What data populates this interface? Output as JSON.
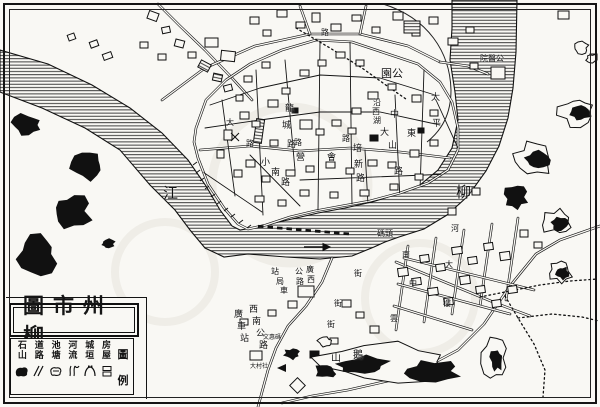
{
  "colors": {
    "ink": "#141414",
    "paper": "#f9f8f4",
    "water_hatch": "#2b2b2b"
  },
  "title_box": {
    "text": "圖市州柳"
  },
  "legend": {
    "title_chars": [
      "圖",
      "例"
    ],
    "items": [
      {
        "label_top": "石",
        "label_bottom": "山",
        "symbol": "hill-symbol"
      },
      {
        "label_top": "道",
        "label_bottom": "路",
        "symbol": "road-symbol"
      },
      {
        "label_top": "池",
        "label_bottom": "塘",
        "symbol": "pond-symbol"
      },
      {
        "label_top": "河",
        "label_bottom": "流",
        "symbol": "river-symbol"
      },
      {
        "label_top": "城",
        "label_bottom": "垣",
        "symbol": "wall-symbol"
      },
      {
        "label_top": "房",
        "label_bottom": "屋",
        "symbol": "house-symbol"
      }
    ]
  },
  "river": {
    "name": "柳江"
  },
  "map_labels": [
    {
      "t": "江",
      "x": 163,
      "y": 186,
      "s": 15,
      "name": "river-name-jiang"
    },
    {
      "t": "柳",
      "x": 456,
      "y": 185,
      "s": 15,
      "name": "river-name-liu"
    },
    {
      "t": "園公",
      "x": 381,
      "y": 68,
      "s": 11,
      "name": "park-label"
    },
    {
      "t": "院醫公",
      "x": 480,
      "y": 55,
      "s": 8,
      "name": "hospital-label"
    },
    {
      "t": "龍",
      "x": 285,
      "y": 105,
      "s": 9
    },
    {
      "t": "城",
      "x": 282,
      "y": 122,
      "s": 9
    },
    {
      "t": "路",
      "x": 287,
      "y": 141,
      "s": 9
    },
    {
      "t": "小",
      "x": 261,
      "y": 159,
      "s": 9
    },
    {
      "t": "南",
      "x": 271,
      "y": 169,
      "s": 9
    },
    {
      "t": "路",
      "x": 281,
      "y": 179,
      "s": 9
    },
    {
      "t": "中",
      "x": 390,
      "y": 111,
      "s": 9
    },
    {
      "t": "山",
      "x": 388,
      "y": 142,
      "s": 9
    },
    {
      "t": "路",
      "x": 394,
      "y": 168,
      "s": 9
    },
    {
      "t": "東",
      "x": 407,
      "y": 130,
      "s": 9
    },
    {
      "t": "太",
      "x": 431,
      "y": 94,
      "s": 9
    },
    {
      "t": "平",
      "x": 432,
      "y": 120,
      "s": 9
    },
    {
      "t": "培",
      "x": 353,
      "y": 145,
      "s": 9
    },
    {
      "t": "新",
      "x": 354,
      "y": 161,
      "s": 9
    },
    {
      "t": "路",
      "x": 356,
      "y": 175,
      "s": 9
    },
    {
      "t": "沿",
      "x": 373,
      "y": 99,
      "s": 8
    },
    {
      "t": "西",
      "x": 372,
      "y": 108,
      "s": 8
    },
    {
      "t": "湖",
      "x": 373,
      "y": 117,
      "s": 8
    },
    {
      "t": "大",
      "x": 380,
      "y": 129,
      "s": 9
    },
    {
      "t": "營",
      "x": 296,
      "y": 154,
      "s": 9
    },
    {
      "t": "會",
      "x": 327,
      "y": 154,
      "s": 9
    },
    {
      "t": "路",
      "x": 294,
      "y": 139,
      "s": 8
    },
    {
      "t": "路",
      "x": 342,
      "y": 135,
      "s": 8
    },
    {
      "t": "大",
      "x": 226,
      "y": 119,
      "s": 8
    },
    {
      "t": "路",
      "x": 246,
      "y": 140,
      "s": 8
    },
    {
      "t": "路",
      "x": 321,
      "y": 29,
      "s": 8
    },
    {
      "t": "碼頭",
      "x": 377,
      "y": 230,
      "s": 8,
      "name": "wharf-label"
    },
    {
      "t": "廣",
      "x": 306,
      "y": 266,
      "s": 8
    },
    {
      "t": "西",
      "x": 307,
      "y": 276,
      "s": 8
    },
    {
      "t": "公",
      "x": 295,
      "y": 268,
      "s": 8
    },
    {
      "t": "路",
      "x": 296,
      "y": 278,
      "s": 8
    },
    {
      "t": "站",
      "x": 271,
      "y": 268,
      "s": 8
    },
    {
      "t": "局",
      "x": 276,
      "y": 278,
      "s": 8
    },
    {
      "t": "車",
      "x": 280,
      "y": 287,
      "s": 8
    },
    {
      "t": "西",
      "x": 249,
      "y": 306,
      "s": 9
    },
    {
      "t": "南",
      "x": 252,
      "y": 318,
      "s": 9
    },
    {
      "t": "公",
      "x": 256,
      "y": 330,
      "s": 9
    },
    {
      "t": "路",
      "x": 259,
      "y": 342,
      "s": 9
    },
    {
      "t": "廣",
      "x": 234,
      "y": 311,
      "s": 9
    },
    {
      "t": "車",
      "x": 237,
      "y": 323,
      "s": 9
    },
    {
      "t": "站",
      "x": 240,
      "y": 335,
      "s": 9
    },
    {
      "t": "鵝",
      "x": 353,
      "y": 351,
      "s": 10,
      "name": "goose-hill-label"
    },
    {
      "t": "山",
      "x": 331,
      "y": 354,
      "s": 10
    },
    {
      "t": "河",
      "x": 451,
      "y": 225,
      "s": 8
    },
    {
      "t": "南",
      "x": 402,
      "y": 251,
      "s": 8
    },
    {
      "t": "街",
      "x": 354,
      "y": 270,
      "s": 8
    },
    {
      "t": "中",
      "x": 409,
      "y": 280,
      "s": 8
    },
    {
      "t": "街",
      "x": 334,
      "y": 300,
      "s": 8
    },
    {
      "t": "街",
      "x": 327,
      "y": 321,
      "s": 8
    },
    {
      "t": "雲",
      "x": 390,
      "y": 315,
      "s": 8
    },
    {
      "t": "大",
      "x": 445,
      "y": 261,
      "s": 8
    },
    {
      "t": "樓",
      "x": 443,
      "y": 300,
      "s": 8
    },
    {
      "t": "文惠碼",
      "x": 263,
      "y": 335,
      "s": 6
    },
    {
      "t": "大村社",
      "x": 250,
      "y": 364,
      "s": 6
    }
  ]
}
